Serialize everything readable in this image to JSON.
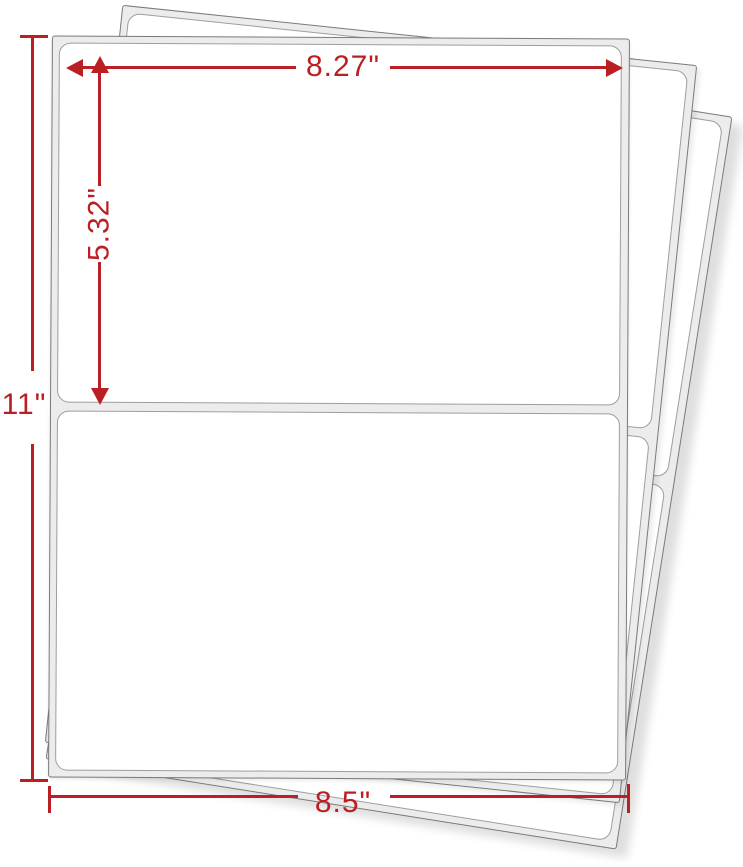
{
  "scene": {
    "description": "Stack of three blank self-adhesive label sheets, two half-sheet labels per sheet",
    "sheet_count": 3,
    "labels_per_sheet": 2,
    "annotation_color": "#bb1e23",
    "sheet_backing_color": "#ececec",
    "sheet_edge_color": "#7a7a7a",
    "label_color": "#ffffff"
  },
  "dimensions": {
    "label_width": "8.27\"",
    "label_height": "5.32\"",
    "sheet_height": "11\"",
    "sheet_width": "8.5\""
  }
}
